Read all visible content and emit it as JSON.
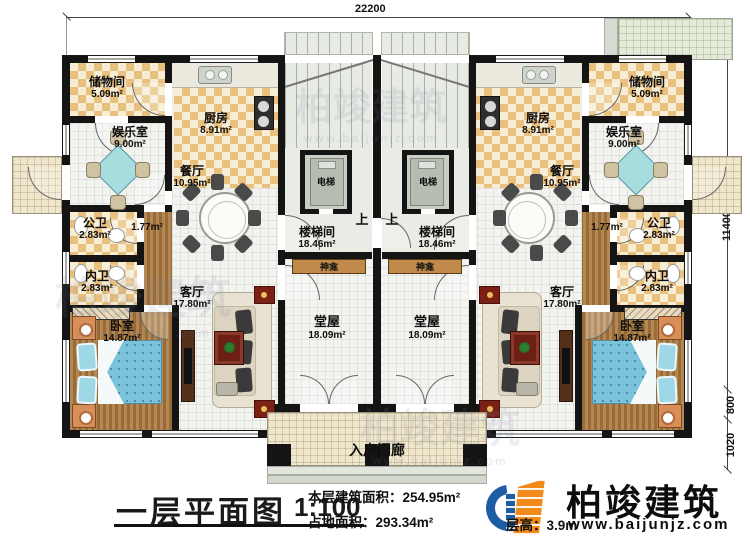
{
  "meta": {
    "plan_title": "一层平面图",
    "scale": "1:100"
  },
  "dimensions": {
    "top": "22200",
    "right_total": "11400",
    "right_mid": "800",
    "right_low": "1020"
  },
  "rooms": {
    "storage": {
      "name": "储物间",
      "area": "5.09m²"
    },
    "kitchen": {
      "name": "厨房",
      "area": "8.91m²"
    },
    "entertainment": {
      "name": "娱乐室",
      "area": "9.00m²"
    },
    "dining": {
      "name": "餐厅",
      "area": "10.95m²"
    },
    "public_wc": {
      "name": "公卫",
      "area": "2.83m²"
    },
    "hallway": {
      "area": "1.77m²"
    },
    "private_wc": {
      "name": "内卫",
      "area": "2.83m²"
    },
    "bedroom": {
      "name": "卧室",
      "area": "14.87m²"
    },
    "living": {
      "name": "客厅",
      "area": "17.80m²"
    },
    "stairwell": {
      "name": "楼梯间",
      "area": "18.46m²"
    },
    "hall": {
      "name": "堂屋",
      "area": "18.09m²"
    },
    "elevator": {
      "name": "电梯"
    },
    "up": {
      "name": "上"
    },
    "shrine": {
      "name": "神龛"
    },
    "porch": {
      "name": "入户门廊"
    }
  },
  "stats": {
    "floor_area_label": "本层建筑面积：",
    "floor_area_value": "254.95m²",
    "land_area_label": "占地面积：",
    "land_area_value": "293.34m²",
    "height_label": "层高：",
    "height_value": "3.9m"
  },
  "brand": {
    "name": "柏竣建筑",
    "website": "www.baijunjz.com"
  },
  "colors": {
    "wall": "#141414",
    "checker": "#e9c07e",
    "wood": "#aa773c",
    "bed": "#7ac3da",
    "game_table": "#a8dde0",
    "brand_blue": "#1e5ca3",
    "brand_orange": "#f28a1b"
  }
}
